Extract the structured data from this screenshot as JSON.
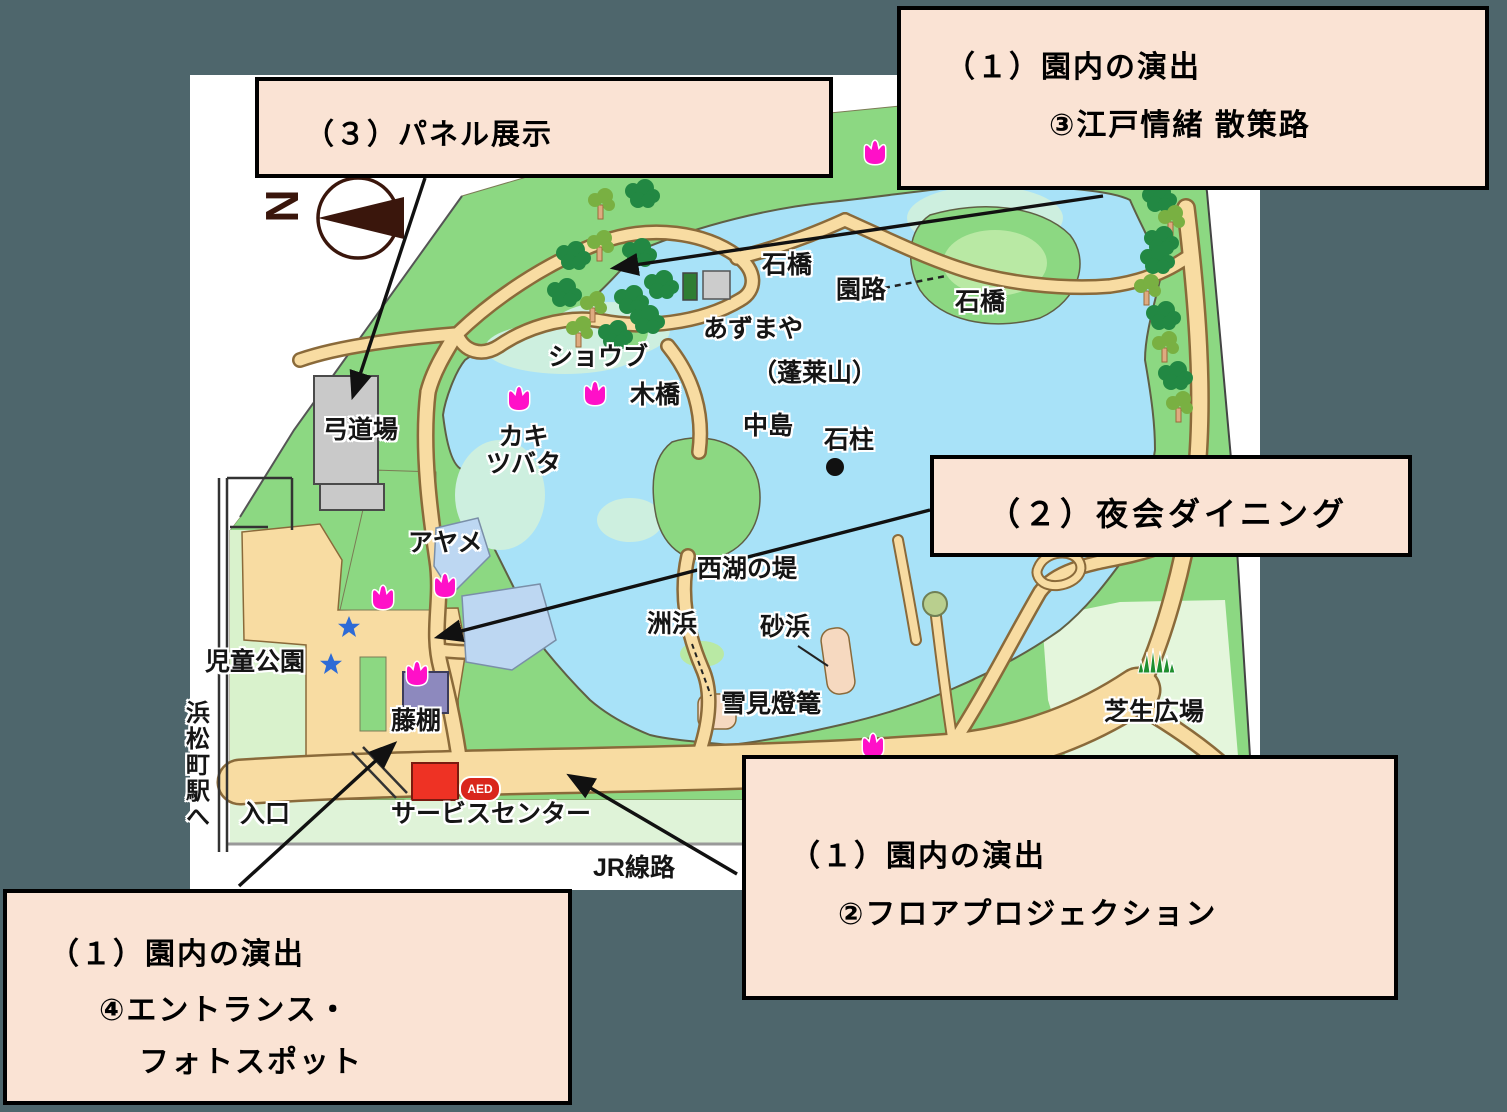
{
  "title": "旧芝離宮恩賜庭園 園内マップ（演出位置図）",
  "colors": {
    "background_slate": "#4E666C",
    "callout_bg": "#FAE3D4",
    "callout_border": "#000000",
    "map_white": "#FFFFFF",
    "park_green": "#8CD882",
    "light_green": "#D9F2CC",
    "pale_strip_green": "#DFF3D8",
    "lawn_pale": "#E4F6DC",
    "pond_blue": "#A8E2F8",
    "shallow_pale": "#CDEFDF",
    "path_tan": "#F8DCA2",
    "sand": "#F6D9C0",
    "building_gray": "#C9C9C9",
    "service_red": "#EE3224",
    "fujidana_purple": "#8D89BE",
    "tulip_magenta": "#FF10C8",
    "star_blue": "#2E6BD6",
    "tree_dark": "#228843",
    "tree_light": "#79B042",
    "compass_brown": "#3A160C",
    "aed_red": "#D9261C"
  },
  "callouts": {
    "top_right": {
      "line1": "（１）園内の演出",
      "line2": "③江戸情緒 散策路"
    },
    "top_left": {
      "line1": "（３）パネル展示"
    },
    "mid_right": {
      "line1": "（２）夜会ダイニング"
    },
    "bottom_right": {
      "line1": "（１）園内の演出",
      "line2": "②フロアプロジェクション"
    },
    "bottom_left": {
      "line1": "（１）園内の演出",
      "line2": "④エントランス・",
      "line3": "フォトスポット"
    }
  },
  "map": {
    "compass_letter": "N",
    "aed_label": "AED",
    "icons": {
      "compass": "compass-north-icon",
      "tulip": "tulip-icon",
      "star": "star-icon",
      "tree_dark": "tree-icon",
      "tree_trunk": "tree-icon",
      "grass": "grass-icon",
      "stone_pillar": "stone-pillar-dot-icon"
    },
    "labels": [
      {
        "name": "ishibashi-west",
        "text": "石橋",
        "x": 762,
        "y": 252,
        "style": ""
      },
      {
        "name": "enro",
        "text": "園路",
        "x": 836,
        "y": 277,
        "style": ""
      },
      {
        "name": "ishibashi-east",
        "text": "石橋",
        "x": 955,
        "y": 289,
        "style": ""
      },
      {
        "name": "azumaya",
        "text": "あずまや",
        "x": 703,
        "y": 316,
        "style": ""
      },
      {
        "name": "horaisan",
        "text": "（蓬莱山）",
        "x": 752,
        "y": 360,
        "style": ""
      },
      {
        "name": "shobu",
        "text": "ショウブ",
        "x": 548,
        "y": 344,
        "style": ""
      },
      {
        "name": "kibashi",
        "text": "木橋",
        "x": 630,
        "y": 382,
        "style": ""
      },
      {
        "name": "nakajima",
        "text": "中島",
        "x": 743,
        "y": 413,
        "style": ""
      },
      {
        "name": "sekichu",
        "text": "石柱",
        "x": 824,
        "y": 427,
        "style": ""
      },
      {
        "name": "kakitsubata",
        "text": "カキ\nツバタ",
        "x": 486,
        "y": 424,
        "style": "c"
      },
      {
        "name": "kyudojo",
        "text": "弓道場",
        "x": 323,
        "y": 417,
        "style": ""
      },
      {
        "name": "ayame",
        "text": "アヤメ",
        "x": 408,
        "y": 530,
        "style": ""
      },
      {
        "name": "jido-koen",
        "text": "児童公園",
        "x": 205,
        "y": 649,
        "style": ""
      },
      {
        "name": "seiko-no-tsutsumi",
        "text": "西湖の堤",
        "x": 697,
        "y": 556,
        "style": ""
      },
      {
        "name": "suhama",
        "text": "洲浜",
        "x": 647,
        "y": 611,
        "style": ""
      },
      {
        "name": "sunahama",
        "text": "砂浜",
        "x": 760,
        "y": 614,
        "style": ""
      },
      {
        "name": "yukimi-toro",
        "text": "雪見燈篭",
        "x": 721,
        "y": 691,
        "style": ""
      },
      {
        "name": "shibafu-hiroba",
        "text": "芝生広場",
        "x": 1104,
        "y": 699,
        "style": ""
      },
      {
        "name": "fujidana",
        "text": "藤棚",
        "x": 391,
        "y": 708,
        "style": ""
      },
      {
        "name": "iriguchi",
        "text": "入口",
        "x": 240,
        "y": 801,
        "style": ""
      },
      {
        "name": "service-center",
        "text": "サービスセンター",
        "x": 391,
        "y": 801,
        "style": ""
      },
      {
        "name": "jr-senro",
        "text": "JR線路",
        "x": 593,
        "y": 855,
        "style": ""
      },
      {
        "name": "hamamatsucho-eki-e",
        "text": "浜松町駅へ",
        "x": 182,
        "y": 700,
        "style": "v"
      }
    ]
  }
}
